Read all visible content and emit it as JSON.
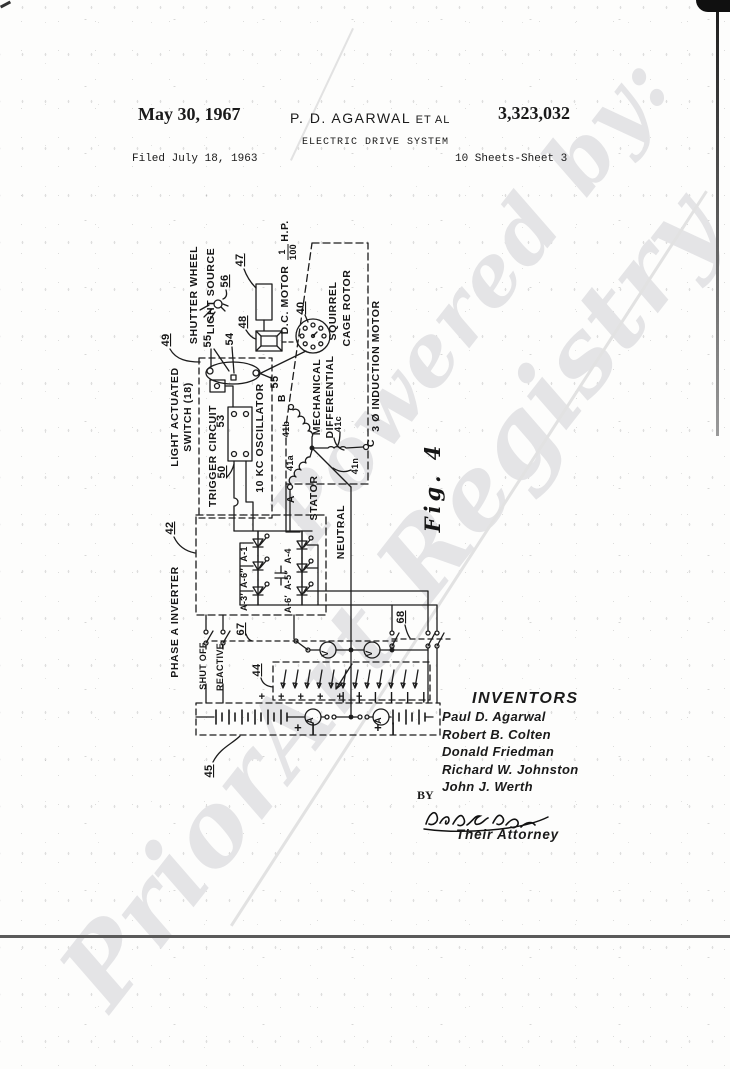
{
  "header": {
    "date": "May 30, 1967",
    "author": "P. D. AGARWAL",
    "etal": "ET AL",
    "number": "3,323,032",
    "title": "ELECTRIC DRIVE SYSTEM",
    "filed": "Filed July 18, 1963",
    "sheet": "10 Sheets-Sheet 3"
  },
  "watermark": {
    "line1": "Powered by:",
    "line2": "PriorArt Registry"
  },
  "figure": {
    "label": "Fig. 4"
  },
  "diagram": {
    "labels": {
      "shutter_wheel": "SHUTTER WHEEL",
      "light_source": "LIGHT SOURCE",
      "dc_motor": "D.C. MOTOR",
      "hp_num": "1",
      "hp_den": "100",
      "hp_unit": "H.P.",
      "squirrel": "SQUIRREL",
      "cage_rotor": "CAGE ROTOR",
      "induction_motor": "3 Ø INDUCTION MOTOR",
      "mechanical": "MECHANICAL",
      "differential": "DIFFERENTIAL",
      "light_actuated": "LIGHT ACTUATED",
      "switch_18": "SWITCH (18)",
      "trigger_circuit": "TRIGGER CIRCUIT",
      "oscillator": "10 KC OSCILLATOR",
      "stator": "STATOR",
      "neutral": "NEUTRAL",
      "phase_a_inverter": "PHASE A INVERTER",
      "shut_off": "SHUT OFF",
      "reactive": "REACTIVE",
      "terminal_a": "A",
      "terminal_b": "B",
      "terminal_c": "C",
      "coil_41a": "41a",
      "coil_41b": "41b",
      "coil_41c": "41c",
      "coil_41n": "41n",
      "meter_v": "V",
      "meter_a": "A"
    },
    "refs": {
      "r40": "40",
      "r42": "42",
      "r44": "44",
      "r45": "45",
      "r47": "47",
      "r48": "48",
      "r49": "49",
      "r50": "50",
      "r53": "53",
      "r54": "54",
      "r55": "55",
      "r56": "56",
      "r67": "67",
      "r68": "68"
    },
    "scr": {
      "a1": "A-1",
      "a6pp": "A-6″",
      "a3p": "A-3′",
      "a4": "A-4",
      "a5pp": "A-5″",
      "a6p": "A-6′"
    },
    "rows": {
      "plus_row": "+ + + + + +",
      "bar_row": "| | | | | |",
      "polarity": "+ |"
    }
  },
  "inventors": {
    "heading": "INVENTORS",
    "names": [
      "Paul D. Agarwal",
      "Robert B. Colten",
      "Donald  Friedman",
      "Richard W. Johnston",
      "John J. Werth"
    ],
    "by": "BY",
    "attorney": "Their Attorney"
  }
}
